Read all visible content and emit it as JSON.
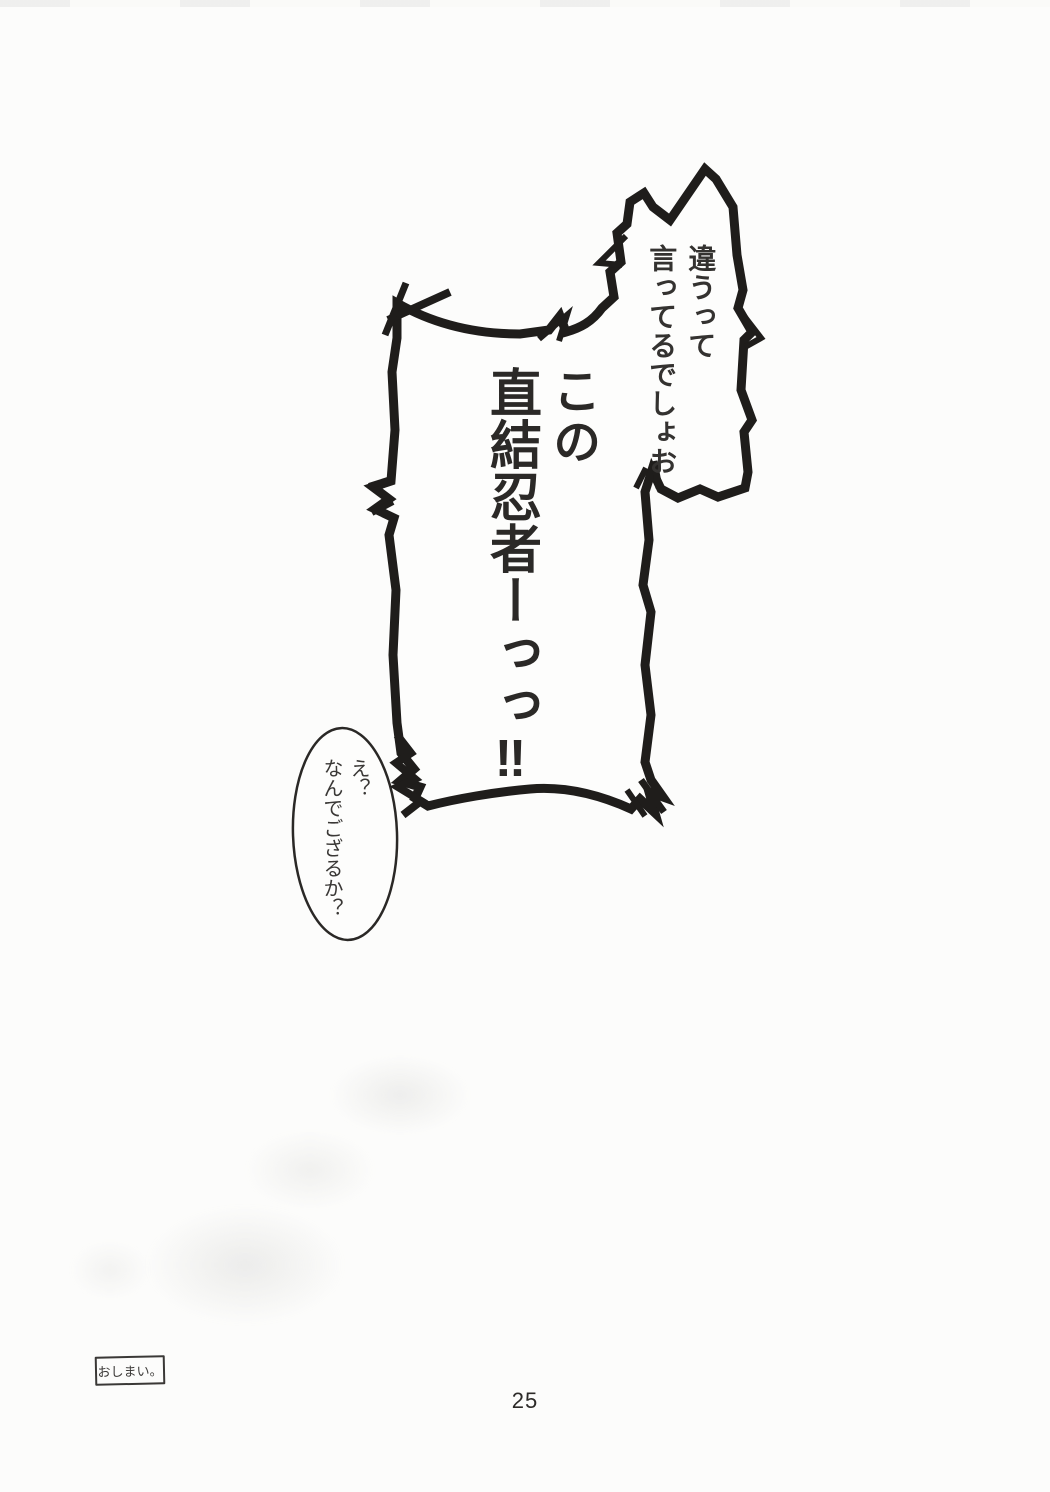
{
  "page": {
    "number": "25",
    "paper_color": "#fcfcfb",
    "ink_color": "#1f1d1b"
  },
  "balloons": {
    "shout": {
      "small_line1": "違うって",
      "small_line2": "言ってるでしょお",
      "large_line1": "この",
      "large_line2": "直結忍者ーっっ‼"
    },
    "reply": {
      "line1": "え？",
      "line2": "なんでござるか？"
    }
  },
  "end_note": {
    "label": "おしまい。"
  }
}
